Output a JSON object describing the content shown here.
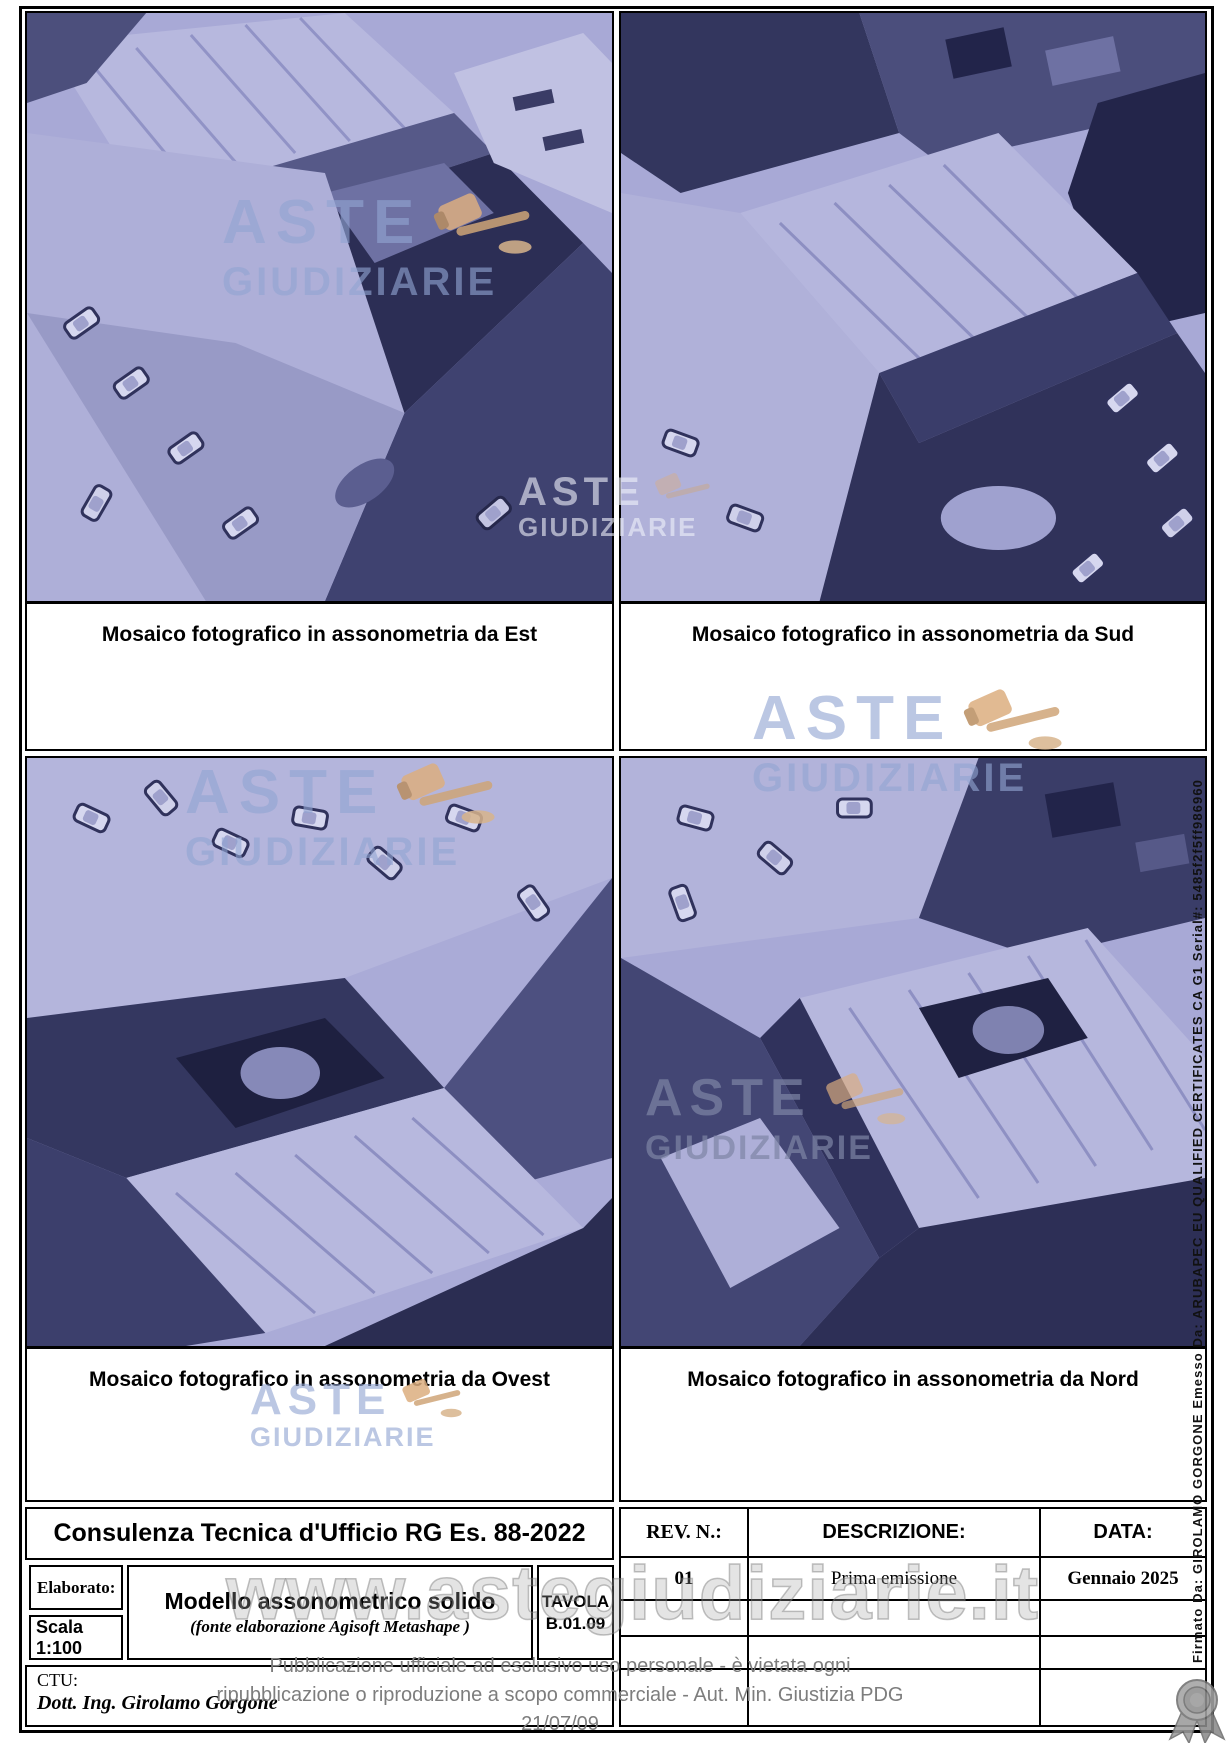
{
  "panels": [
    {
      "caption": "Mosaico fotografico in assonometria da Est"
    },
    {
      "caption": "Mosaico fotografico in assonometria da Sud"
    },
    {
      "caption": "Mosaico fotografico in assonometria da Ovest"
    },
    {
      "caption": "Mosaico fotografico in assonometria da Nord"
    }
  ],
  "watermark": {
    "logo_top": "ASTE",
    "logo_bottom": "GIUDIZIARIE",
    "site": "www.astegiudiziarie.it"
  },
  "title_block": {
    "project_title": "Consulenza Tecnica d'Ufficio RG Es. 88-2022",
    "elaborato_label": "Elaborato:",
    "scala": "Scala 1:100",
    "drawing_title": "Modello assonometrico solido",
    "drawing_subtitle": "(fonte elaborazione Agisoft Metashape )",
    "tavola_label": "TAVOLA",
    "tavola_number": "B.01.09",
    "ctu_label": "CTU:",
    "ctu_name": "Dott. Ing. Girolamo Gorgone"
  },
  "revision_table": {
    "headers": {
      "rev": "REV. N.:",
      "descrizione": "DESCRIZIONE:",
      "data": "DATA:"
    },
    "rows": [
      {
        "rev": "01",
        "descrizione": "Prima emissione",
        "data": "Gennaio 2025"
      },
      {
        "rev": "",
        "descrizione": "",
        "data": ""
      },
      {
        "rev": "",
        "descrizione": "",
        "data": ""
      },
      {
        "rev": "",
        "descrizione": "",
        "data": ""
      }
    ]
  },
  "footer": {
    "disclaimer_line1": "Pubblicazione ufficiale ad esclusivo uso personale - è vietata ogni",
    "disclaimer_line2": "ripubblicazione o riproduzione a scopo commerciale - Aut. Min. Giustizia PDG 21/07/09"
  },
  "signature": {
    "vertical_text": "Firmato Da: GIROLAMO GORGONE Emesso Da: ARUBAPEC EU QUALIFIED CERTIFICATES CA G1 Serial#: 5485f2f5ff986960"
  },
  "colors": {
    "model_lavender": "#a8a9d6",
    "model_shadow": "#2c2e55",
    "watermark_blue": "#91a5d2",
    "gavel_tan": "#d9aa7e",
    "disclaimer_gray": "#7d7d7d"
  }
}
